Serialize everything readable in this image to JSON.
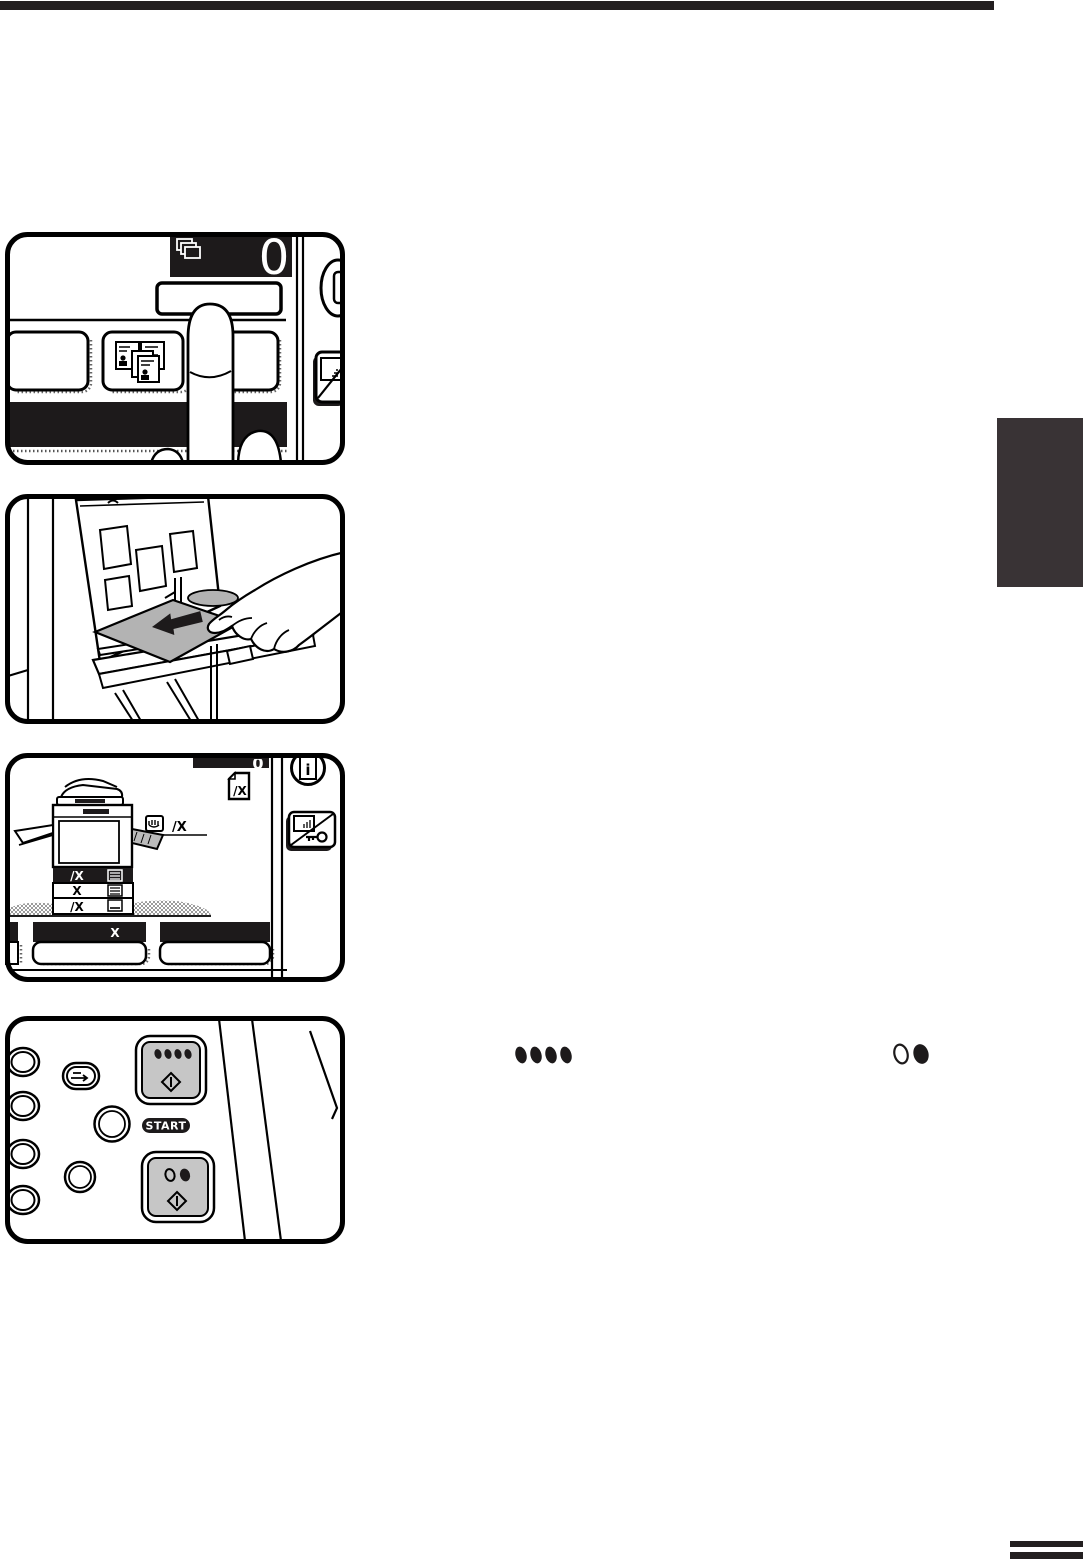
{
  "page": {
    "background": "#ffffff",
    "ink_color": "#1d1a1b",
    "chapter_tab_color": "#393335",
    "key_gray": "#c6c6c6",
    "paper_gray": "#b3b3b3"
  },
  "panel_press_key": {
    "copy_count": "0"
  },
  "panel_tray_display": {
    "counter_digit": "0",
    "paper_size_icon_label": "/X",
    "bypass_size_label": "/X",
    "tray_rows": [
      {
        "label": "/X",
        "selected": true
      },
      {
        "label": "X",
        "selected": false
      },
      {
        "label": "/X",
        "selected": false
      }
    ],
    "bottom_key_label": "X",
    "info_icon_letter": "i"
  },
  "panel_start_keys": {
    "start_label": "START"
  }
}
